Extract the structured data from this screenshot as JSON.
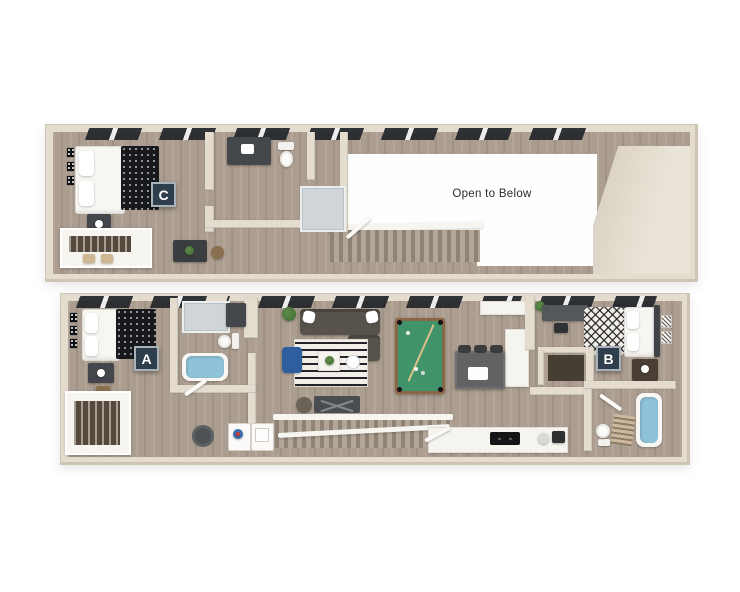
{
  "figure": {
    "type": "3d-floorplan",
    "background": "#ffffff"
  },
  "labels": {
    "open_to_below": "Open to Below",
    "unit_c": "C",
    "unit_a": "A",
    "unit_b": "B"
  },
  "palette": {
    "wall": "#e3dccf",
    "wall_shadow": "#cdc4b2",
    "wood_floor": "#ab9d8f",
    "open_area": "#fefefe",
    "badge_background": "#2e3e4c",
    "badge_border": "#a9b2b8",
    "badge_text": "#ffffff",
    "window_glass": "#23262b",
    "pool_table_felt": "#41946a",
    "pool_table_frame": "#8a6648",
    "bathtub_blue": "#8fc3da",
    "armchair_blue": "#2e5e9e",
    "sofa_gray": "#57534c",
    "duvet_dark": "#17191d",
    "text_color": "#2b2b2b"
  }
}
